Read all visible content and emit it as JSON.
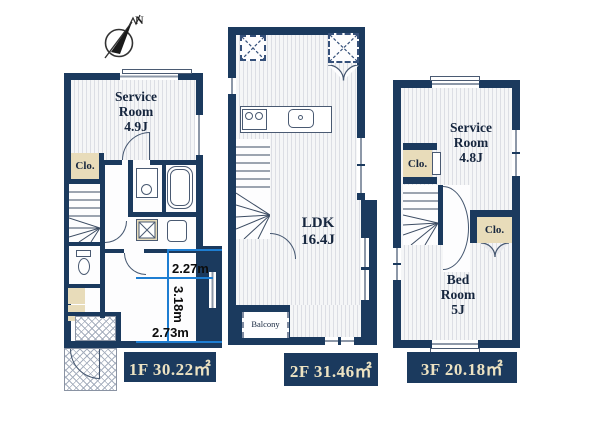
{
  "compass": {
    "label": "N"
  },
  "floor1": {
    "service_room": "Service\nRoom\n4.9J",
    "closet": "Clo.",
    "label": "1F 30.22㎡"
  },
  "floor2": {
    "ldk": "LDK\n16.4J",
    "balcony": "Balcony",
    "label": "2F 31.46㎡"
  },
  "floor3": {
    "service_room": "Service\nRoom\n4.8J",
    "closet_left": "Clo.",
    "closet_right": "Clo.",
    "bed_room": "Bed\nRoom\n5J",
    "label": "3F 20.18㎡"
  },
  "dimensions": {
    "width_top": "2.27m",
    "height": "3.18m",
    "width_bottom": "2.73m"
  },
  "colors": {
    "wall": "#1b3a5e",
    "room_fill": "#e9eaee",
    "closet_fill": "#e8dcba",
    "label_bg": "#1b3a5e",
    "label_text": "#ede3c2",
    "dimension_line": "#1e7ed2"
  }
}
